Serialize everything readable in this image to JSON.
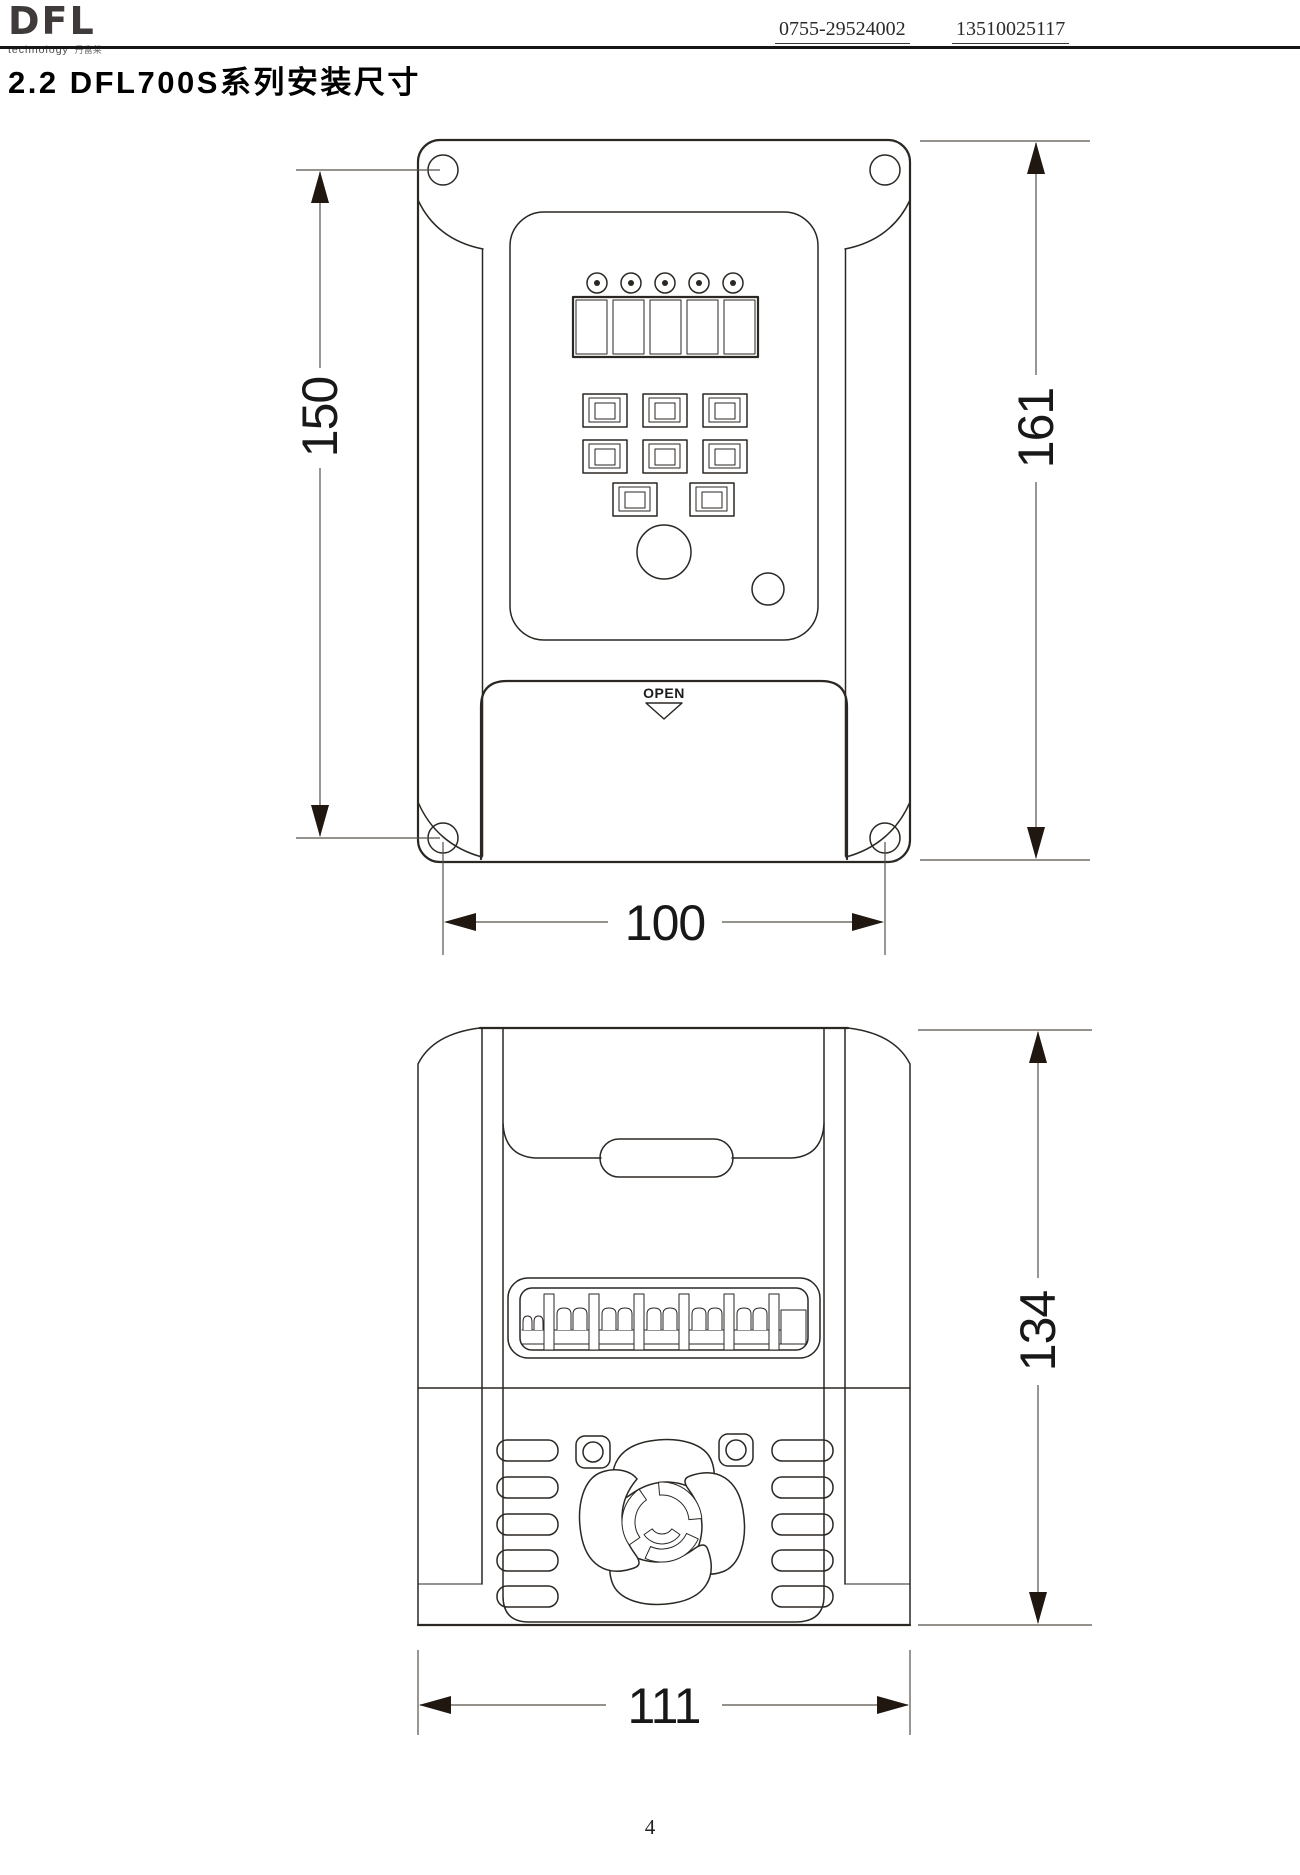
{
  "header": {
    "logo_text": "DFL",
    "logo_sub": "technology",
    "logo_cn": "丹富莱",
    "phone_1": "0755-29524002",
    "phone_2": "13510025117"
  },
  "title": "2.2 DFL700S系列安装尺寸",
  "drawing": {
    "front_view": {
      "open_label": "OPEN",
      "dim_mounting_hole_spacing": "150",
      "dim_total_height": "161",
      "dim_width": "100"
    },
    "side_view": {
      "dim_height": "134",
      "dim_width": "111"
    }
  },
  "footer": {
    "page_number": "4"
  }
}
